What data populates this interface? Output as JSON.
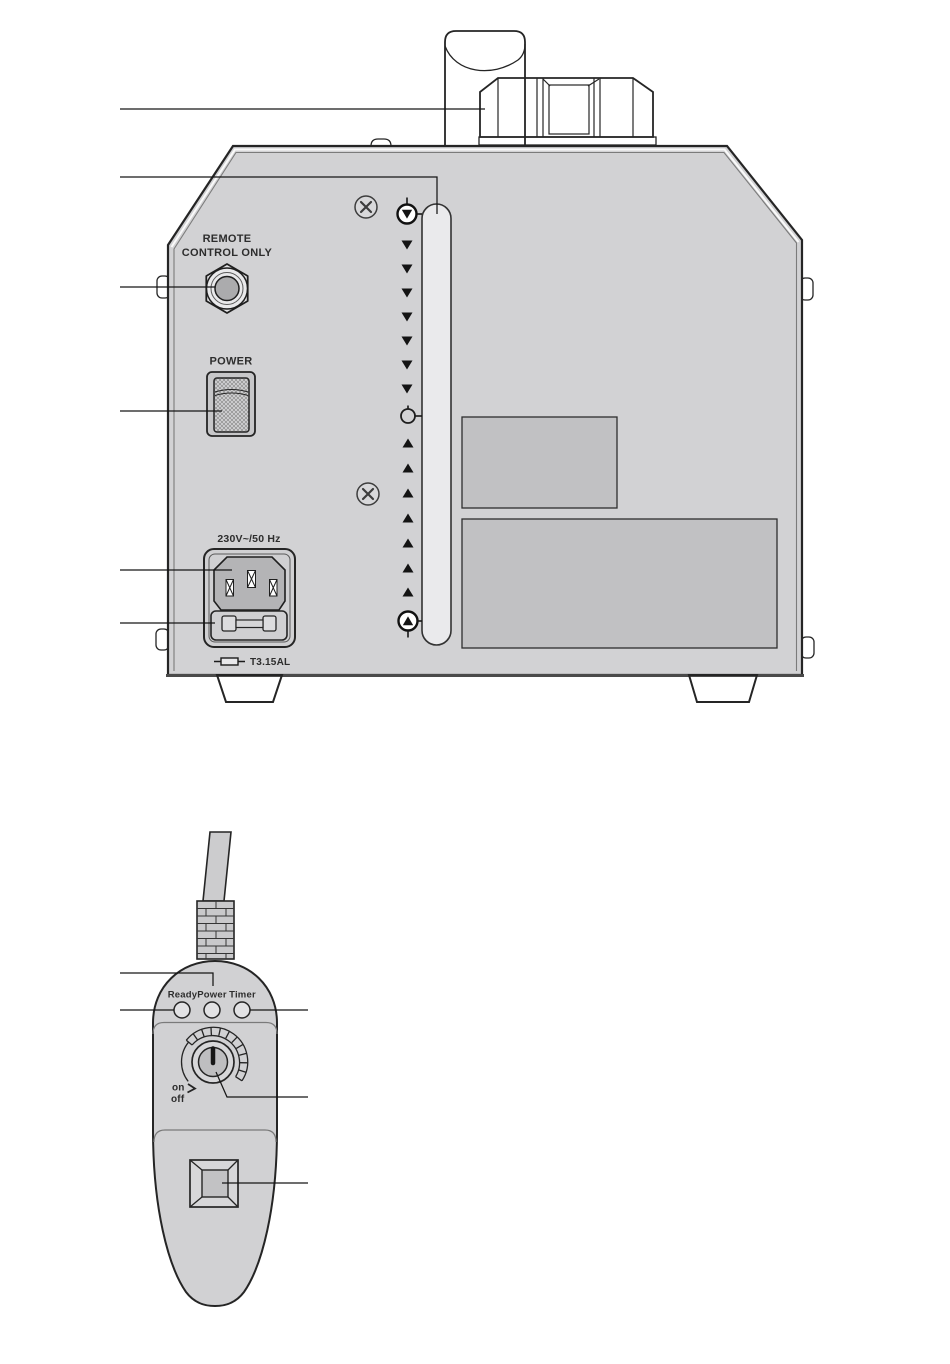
{
  "machine_panel": {
    "remote_jack_label_line1": "REMOTE",
    "remote_jack_label_line2": "CONTROL ONLY",
    "power_switch_label": "POWER",
    "mains_rating_label": "230V~/50 Hz",
    "fuse_rating_label": "T3.15AL"
  },
  "level_gauge": {
    "down_arrow_count": 7,
    "up_arrow_count": 7,
    "max_marker": "circle-with-down-triangle",
    "mid_marker": "open-circle",
    "min_marker": "circle-with-up-triangle"
  },
  "remote_control": {
    "led_labels": [
      "Ready",
      "Power",
      "Timer"
    ],
    "knob_on_label": "on",
    "knob_off_label": "off"
  },
  "colors": {
    "background": "#ffffff",
    "line": "#252525",
    "panel_fill": "#d2d2d4",
    "sticker_fill": "#c1c1c3",
    "tube_fill": "#eaeaec",
    "recess_fill": "#b4b4b6",
    "switch_frame_fill": "#c7c7c9",
    "remote_body_fill": "#d1d1d3",
    "knob_face_fill": "#bebec0",
    "jack_hole_fill": "#ababad"
  }
}
